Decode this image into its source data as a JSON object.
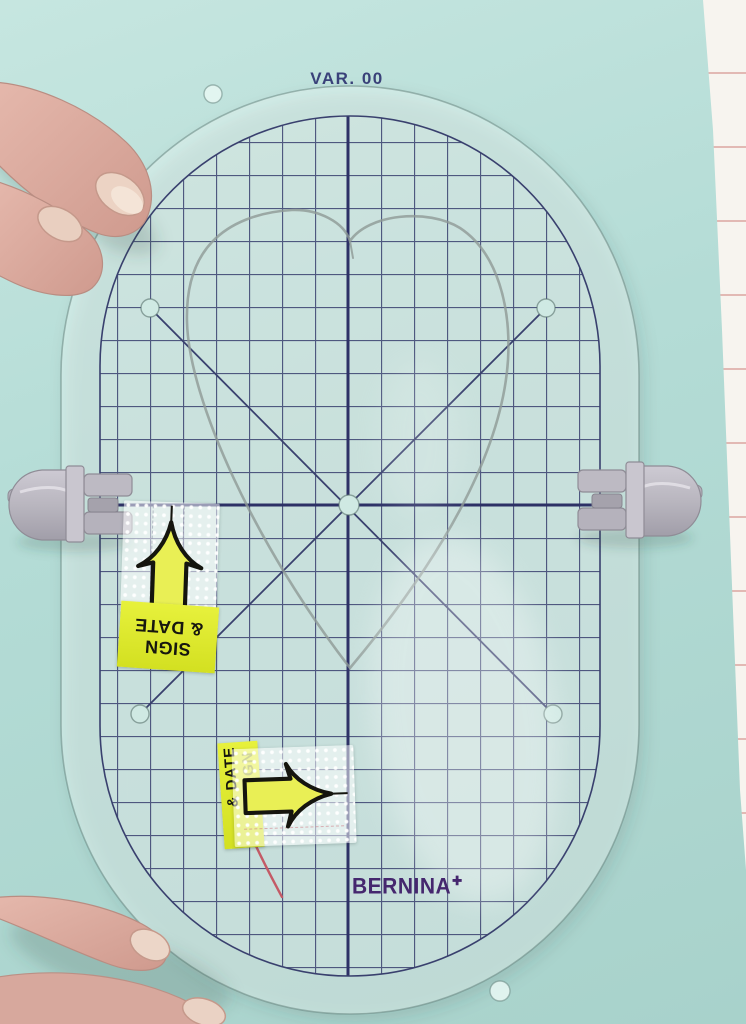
{
  "photo": {
    "template": {
      "variant_label": "VAR. 00",
      "brand": "BERNINA",
      "brand_plus": "✚"
    },
    "stickers": {
      "upper": {
        "line1": "SIGN",
        "line2": "& DATE",
        "arrow_direction": "up"
      },
      "lower": {
        "line1": "SIGN",
        "line2": "& DATE",
        "arrow_direction": "right"
      }
    },
    "colors": {
      "fabric_teal": "#b4dcd6",
      "grid_line": "#39406e",
      "brand_purple": "#45276e",
      "sticker_yellow": "#dce62a",
      "clip_gray": "#b9b6bf",
      "pencil_gray": "#8f9a96",
      "background_white": "#f7f4ef",
      "plank_line": "#e2b9b4",
      "pin_red": "#c45a66"
    }
  }
}
